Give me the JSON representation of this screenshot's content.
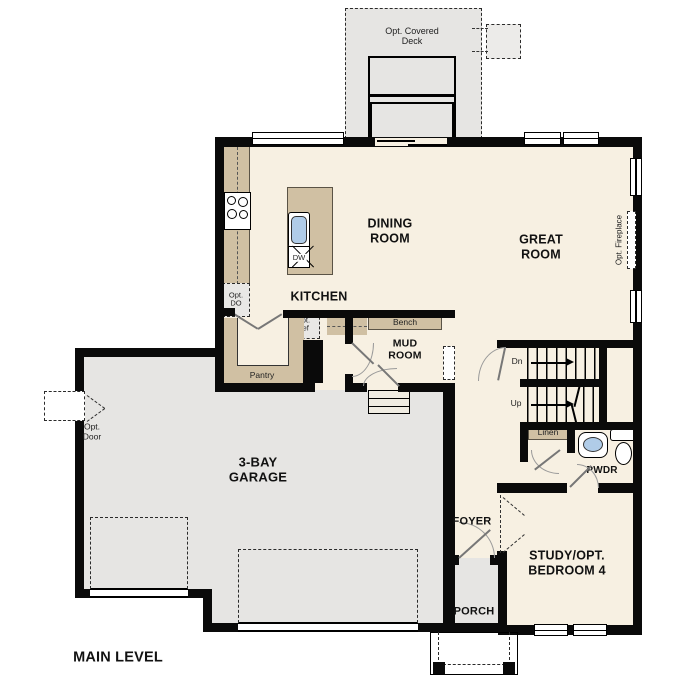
{
  "title": "MAIN LEVEL",
  "rooms": {
    "dining_room": "DINING\nROOM",
    "great_room": "GREAT\nROOM",
    "kitchen": "KITCHEN",
    "mud_room": "MUD\nROOM",
    "garage": "3-BAY\nGARAGE",
    "foyer": "FOYER",
    "porch": "PORCH",
    "study": "STUDY/OPT.\nBEDROOM 4",
    "powder": "PWDR",
    "pantry": "Pantry"
  },
  "features": {
    "deck": "Opt. Covered\nDeck",
    "fireplace": "Opt. Fireplace",
    "opt_door": "Opt.\nDoor",
    "opt_double_oven": "Opt.\nDO",
    "opt_fridge": "Opt.\nRef",
    "bench": "Bench",
    "linen": "Linen",
    "dishwasher": "DW",
    "stairs_down": "Dn",
    "stairs_up": "Up"
  },
  "colors": {
    "floor": "#f7f0e2",
    "casework": "#d0c0a3",
    "garage_floor": "#e6e5e3",
    "fixture_blue": "#b0cce8",
    "wall": "#0a0a0a"
  }
}
